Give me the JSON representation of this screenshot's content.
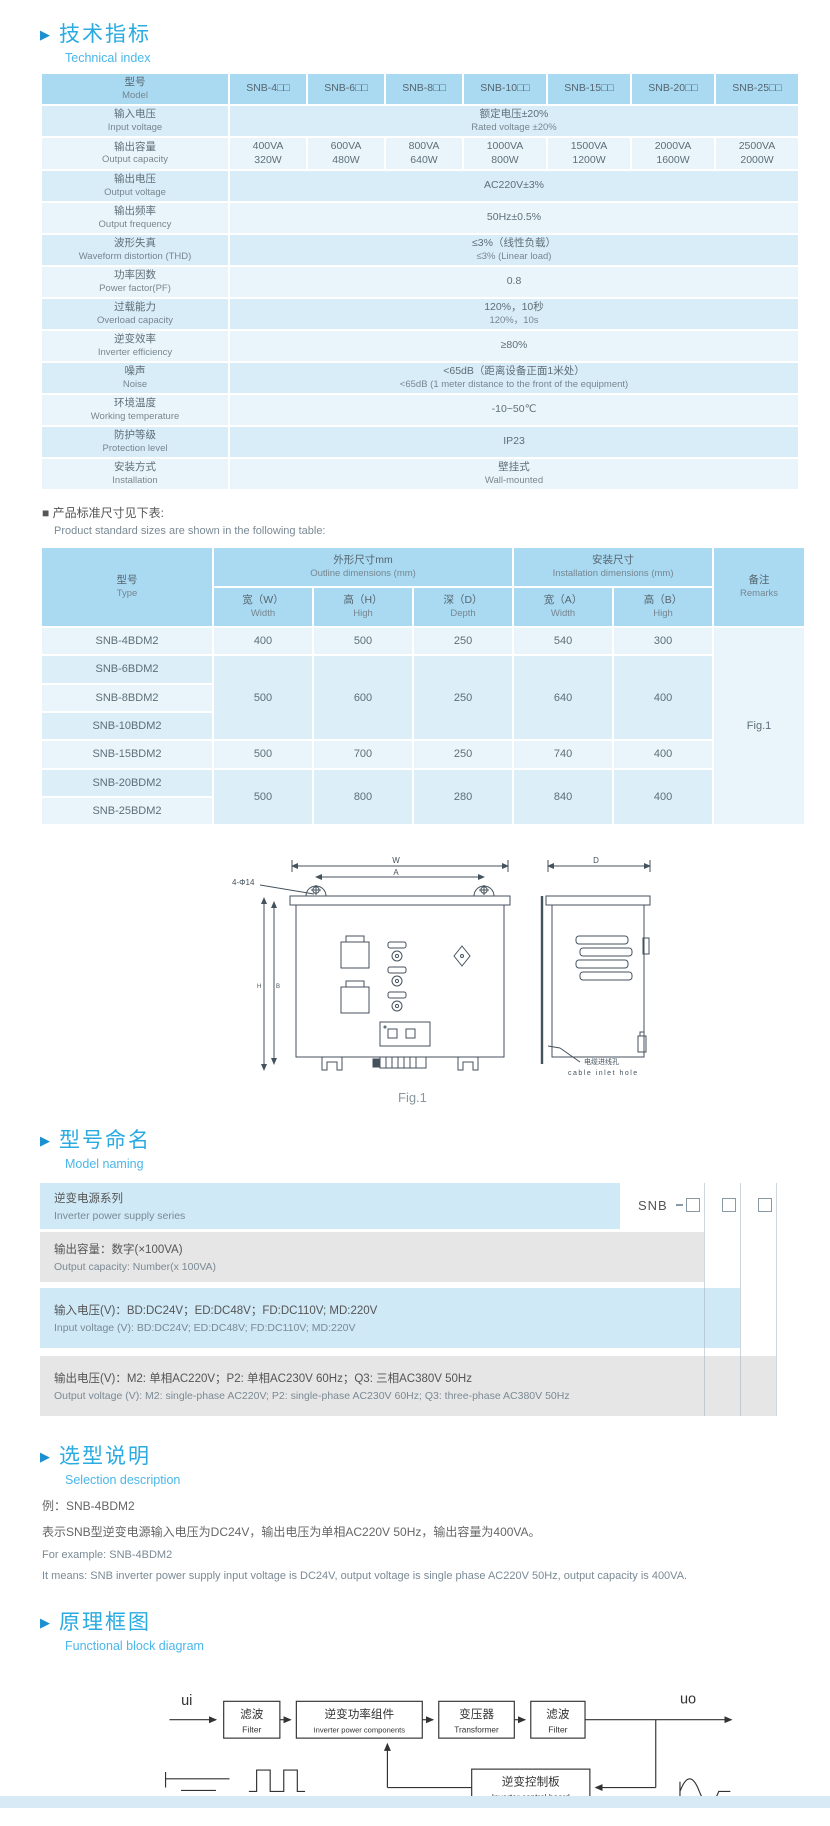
{
  "colors": {
    "accent": "#29abe2",
    "subtitle": "#4ab7ea",
    "table_header": "#a9daf2",
    "row_dark": "#d9edf8",
    "row_light": "#eaf5fb",
    "bar_blue": "#cfe9f7",
    "bar_gray": "#e6e6e6"
  },
  "headings": {
    "technical": {
      "zh": "技术指标",
      "en": "Technical index"
    },
    "naming": {
      "zh": "型号命名",
      "en": "Model naming"
    },
    "selection": {
      "zh": "选型说明",
      "en": "Selection description"
    },
    "block": {
      "zh": "原理框图",
      "en": "Functional block diagram"
    }
  },
  "spec_table": {
    "model_label": {
      "zh": "型号",
      "en": "Model"
    },
    "models": [
      "SNB-4□□",
      "SNB-6□□",
      "SNB-8□□",
      "SNB-10□□",
      "SNB-15□□",
      "SNB-20□□",
      "SNB-25□□"
    ],
    "rows": [
      {
        "label_zh": "输入电压",
        "label_en": "Input voltage",
        "value_zh": "额定电压±20%",
        "value_en": "Rated voltage ±20%"
      },
      {
        "label_zh": "输出容量",
        "label_en": "Output capacity",
        "values": [
          {
            "va": "400VA",
            "w": "320W"
          },
          {
            "va": "600VA",
            "w": "480W"
          },
          {
            "va": "800VA",
            "w": "640W"
          },
          {
            "va": "1000VA",
            "w": "800W"
          },
          {
            "va": "1500VA",
            "w": "1200W"
          },
          {
            "va": "2000VA",
            "w": "1600W"
          },
          {
            "va": "2500VA",
            "w": "2000W"
          }
        ]
      },
      {
        "label_zh": "输出电压",
        "label_en": "Output voltage",
        "value": "AC220V±3%"
      },
      {
        "label_zh": "输出频率",
        "label_en": "Output frequency",
        "value": "50Hz±0.5%"
      },
      {
        "label_zh": "波形失真",
        "label_en": "Waveform distortion (THD)",
        "value_zh": "≤3%（线性负载）",
        "value_en": "≤3% (Linear load)"
      },
      {
        "label_zh": "功率因数",
        "label_en": "Power factor(PF)",
        "value": "0.8"
      },
      {
        "label_zh": "过载能力",
        "label_en": "Overload capacity",
        "value_zh": "120%，10秒",
        "value_en": "120%，10s"
      },
      {
        "label_zh": "逆变效率",
        "label_en": "Inverter efficiency",
        "value": "≥80%"
      },
      {
        "label_zh": "噪声",
        "label_en": "Noise",
        "value_zh": "<65dB（距离设备正面1米处）",
        "value_en": "<65dB (1 meter distance to the front of the equipment)"
      },
      {
        "label_zh": "环境温度",
        "label_en": "Working temperature",
        "value": "-10~50℃"
      },
      {
        "label_zh": "防护等级",
        "label_en": "Protection level",
        "value": "IP23"
      },
      {
        "label_zh": "安装方式",
        "label_en": "Installation",
        "value_zh": "壁挂式",
        "value_en": "Wall-mounted"
      }
    ]
  },
  "size_note": {
    "zh": "■ 产品标准尺寸见下表:",
    "en": "Product standard sizes are shown in the following table:"
  },
  "dim_table": {
    "type_label": {
      "zh": "型号",
      "en": "Type"
    },
    "outline_group": {
      "zh": "外形尺寸mm",
      "en": "Outline dimensions (mm)"
    },
    "install_group": {
      "zh": "安装尺寸",
      "en": "Installation dimensions (mm)"
    },
    "remarks_label": {
      "zh": "备注",
      "en": "Remarks"
    },
    "sub_headers": [
      {
        "zh": "宽（W）",
        "en": "Width"
      },
      {
        "zh": "高（H）",
        "en": "High"
      },
      {
        "zh": "深（D）",
        "en": "Depth"
      },
      {
        "zh": "宽（A）",
        "en": "Width"
      },
      {
        "zh": "高（B）",
        "en": "High"
      }
    ],
    "rows": [
      {
        "type": "SNB-4BDM2",
        "w": "400",
        "h": "500",
        "d": "250",
        "a": "540",
        "b": "300"
      },
      {
        "type": "SNB-6BDM2",
        "w": "500",
        "h": "600",
        "d": "250",
        "a": "640",
        "b": "400"
      },
      {
        "type": "SNB-8BDM2"
      },
      {
        "type": "SNB-10BDM2"
      },
      {
        "type": "SNB-15BDM2",
        "w": "500",
        "h": "700",
        "d": "250",
        "a": "740",
        "b": "400"
      },
      {
        "type": "SNB-20BDM2",
        "w": "500",
        "h": "800",
        "d": "280",
        "a": "840",
        "b": "400"
      },
      {
        "type": "SNB-25BDM2"
      }
    ],
    "remark_value": "Fig.1"
  },
  "drawing": {
    "caption": "Fig.1",
    "labels": {
      "w": "W",
      "a": "A",
      "d": "D",
      "h": "H",
      "b": "B",
      "holes": "4-Φ14",
      "cable_zh": "电缆进线孔",
      "cable_en": "cable inlet hole"
    }
  },
  "naming": {
    "code": "SNB",
    "rows": [
      {
        "zh": "逆变电源系列",
        "en": "Inverter power supply series"
      },
      {
        "zh": "输出容量：数字(×100VA)",
        "en": "Output capacity: Number(x 100VA)"
      },
      {
        "zh": "输入电压(V)：BD:DC24V；ED:DC48V；FD:DC110V; MD:220V",
        "en": "Input voltage (V): BD:DC24V; ED:DC48V; FD:DC110V; MD:220V"
      },
      {
        "zh": "输出电压(V)：M2: 单相AC220V；P2: 单相AC230V 60Hz；Q3: 三相AC380V 50Hz",
        "en": "Output voltage (V): M2: single-phase AC220V; P2: single-phase AC230V 60Hz; Q3: three-phase AC380V 50Hz"
      }
    ]
  },
  "selection": {
    "line1": "例：SNB-4BDM2",
    "line2": "表示SNB型逆变电源输入电压为DC24V，输出电压为单相AC220V 50Hz，输出容量为400VA。",
    "line3": "For example: SNB-4BDM2",
    "line4": "It means: SNB inverter power supply input voltage is DC24V, output voltage is single phase AC220V 50Hz, output capacity is 400VA."
  },
  "block_diagram": {
    "input_label": "ui",
    "output_label": "uo",
    "blocks": [
      {
        "zh": "滤波",
        "en": "Filter"
      },
      {
        "zh": "逆变功率组件",
        "en": "Inverter power components"
      },
      {
        "zh": "变压器",
        "en": "Transformer"
      },
      {
        "zh": "滤波",
        "en": "Filter"
      },
      {
        "zh": "逆变控制板",
        "en": "Inverter control board"
      }
    ]
  }
}
